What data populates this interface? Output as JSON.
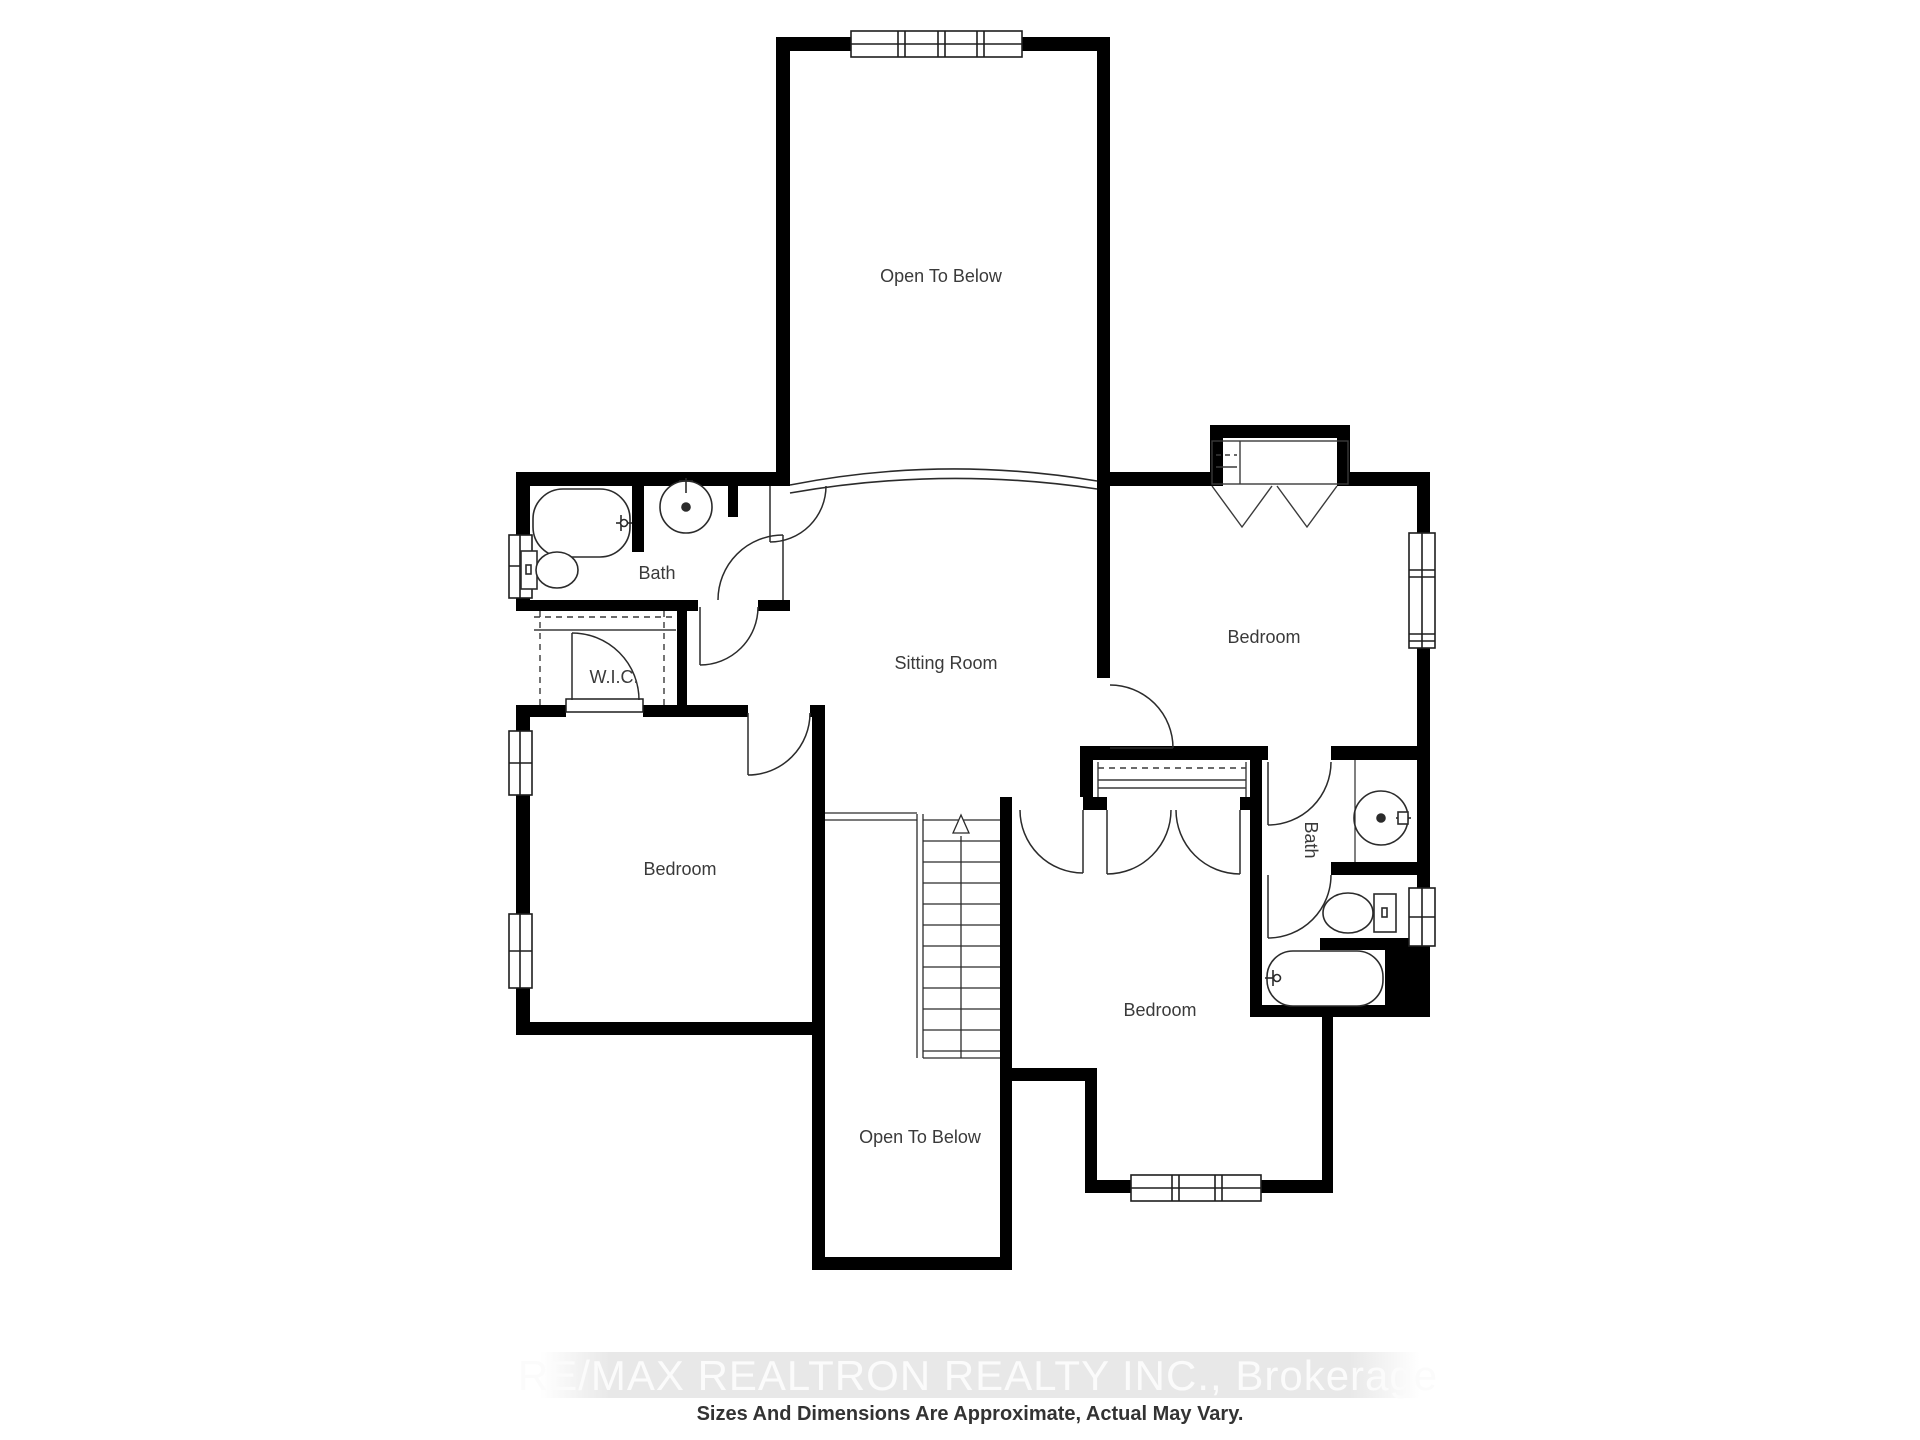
{
  "floorplan": {
    "rooms": [
      {
        "id": "open-to-below-upper",
        "label": "Open To Below"
      },
      {
        "id": "bath-upper",
        "label": "Bath"
      },
      {
        "id": "wic",
        "label": "W.I.C."
      },
      {
        "id": "sitting-room",
        "label": "Sitting Room"
      },
      {
        "id": "bedroom-upper-right",
        "label": "Bedroom"
      },
      {
        "id": "bedroom-left",
        "label": "Bedroom"
      },
      {
        "id": "bedroom-lower",
        "label": "Bedroom"
      },
      {
        "id": "bath-lower",
        "label": "Bath"
      },
      {
        "id": "open-to-below-lower",
        "label": "Open To Below"
      }
    ],
    "fixtures": [
      "bathtub",
      "sink",
      "toilet",
      "closet-shelves",
      "stairs-up-arrow",
      "double-closet-doors",
      "bifold-chevron-doors",
      "windows",
      "door-swings",
      "archway",
      "railing"
    ]
  },
  "footer": {
    "watermark": "RE/MAX REALTRON REALTY INC., Brokerage",
    "disclaimer": "Sizes And Dimensions Are Approximate, Actual May Vary."
  },
  "colors": {
    "walls": "#000000",
    "thin_lines": "#2b2b2b",
    "labels": "#3a3a3a",
    "watermark_band": "#e8e8e8",
    "watermark_text": "#fbfbfb",
    "disclaimer_text": "#333333",
    "background": "#ffffff"
  }
}
